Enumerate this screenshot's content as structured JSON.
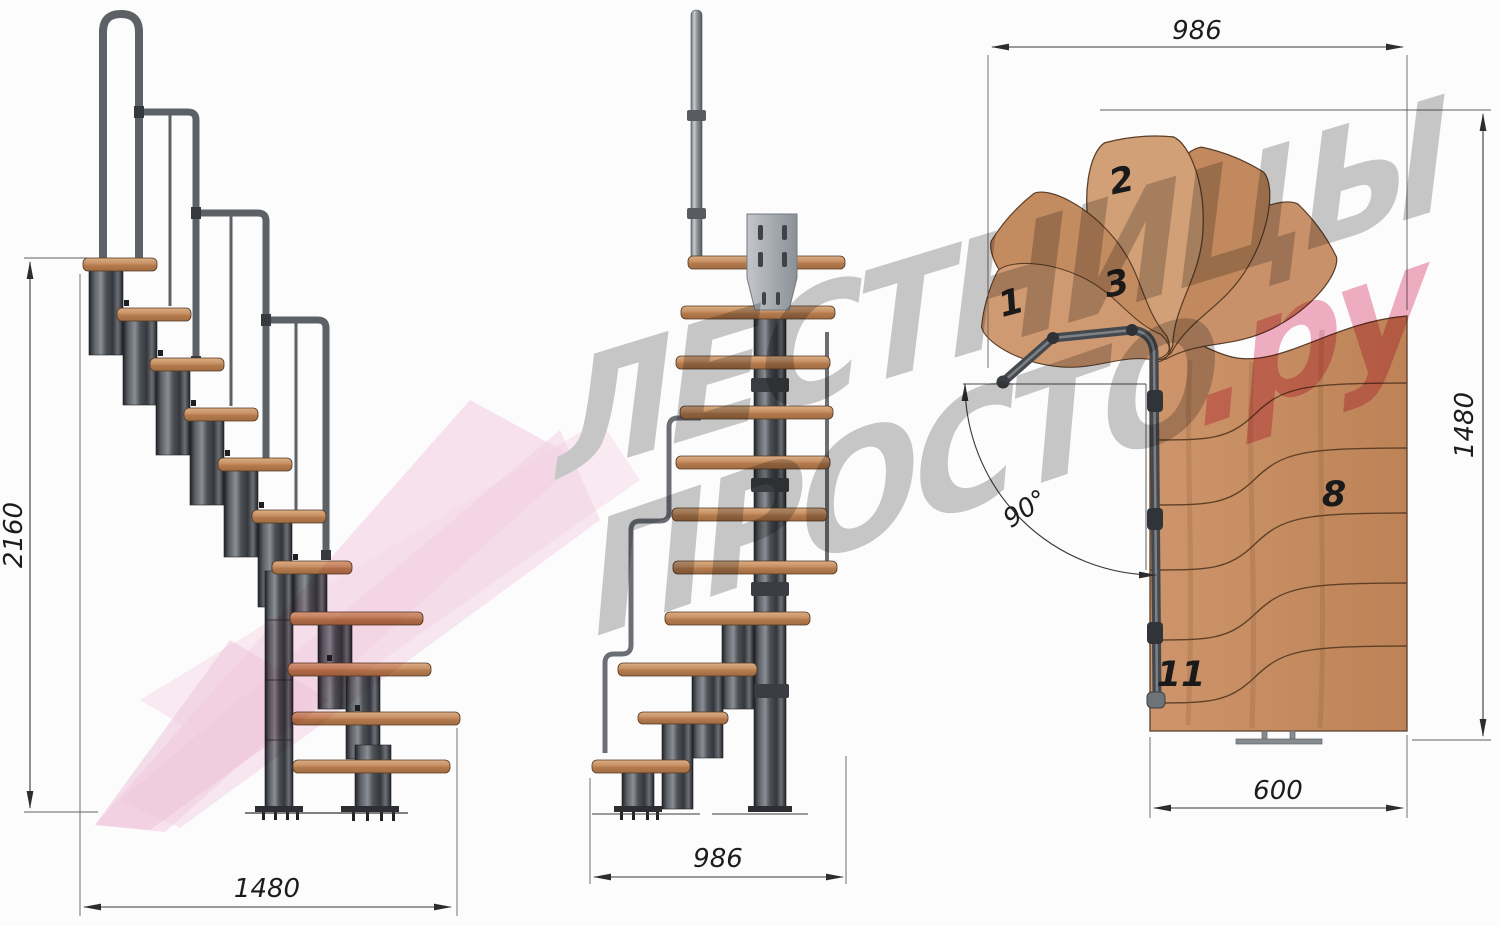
{
  "watermark": {
    "line1": "ЛЕСТНИЦЫ",
    "line2": "ПРОСТО",
    "suffix": ".ру"
  },
  "views": {
    "side": {
      "title": "side-elevation",
      "height_mm": "2160",
      "width_mm": "1480"
    },
    "front": {
      "title": "front-elevation",
      "width_mm": "986"
    },
    "plan": {
      "title": "plan-view",
      "width_mm": "986",
      "depth_mm": "1480",
      "exit_mm": "600",
      "angle": "90°",
      "tread_numbers": {
        "n1": "1",
        "n2": "2",
        "n3": "3",
        "n8": "8",
        "n11": "11"
      }
    }
  },
  "colors": {
    "wood": "#c9916a",
    "wood_dark": "#a9734a",
    "metal": "#5d6166",
    "metal_dark": "#3c3f44",
    "dim_text": "#1c1c1c",
    "watermark_gray": "#969696",
    "watermark_pink": "#e26288",
    "logo_pink": "#eea7c8"
  }
}
